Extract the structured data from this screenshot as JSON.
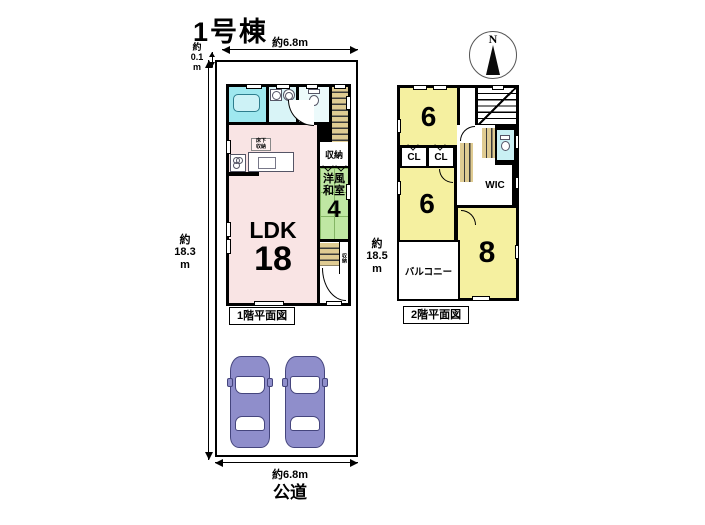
{
  "title": "1号棟",
  "compass": {
    "label": "N"
  },
  "dimensions": {
    "top_width": "約6.8m",
    "offset_left": "約\n0.1\nm",
    "height_left": "約\n18.3\nm",
    "height_right": "約\n18.5\nm",
    "bottom_width": "約6.8m",
    "road_label": "公道"
  },
  "floor1": {
    "caption": "1階平面図",
    "ldk_label": "LDK",
    "ldk_size": "18",
    "washitsu_label": "洋風\n和室",
    "washitsu_size": "4",
    "closet_label": "収納",
    "underfloor_label": "床下\n収納",
    "entry_closet_label": "収納"
  },
  "floor2": {
    "caption": "2階平面図",
    "room1_size": "6",
    "room2_size": "6",
    "room3_size": "8",
    "cl1_label": "CL",
    "cl2_label": "CL",
    "wic_label": "WIC",
    "balcony_label": "バルコニー"
  },
  "colors": {
    "wall": "#000000",
    "ldk": "#f9e4e4",
    "washitsu": "#bfe7a3",
    "bath": "#9fe8ef",
    "bath2": "#d9f4f7",
    "bedroom": "#f5f0a0",
    "stairs": "#dfcb92",
    "car": "#8f8ecb"
  }
}
